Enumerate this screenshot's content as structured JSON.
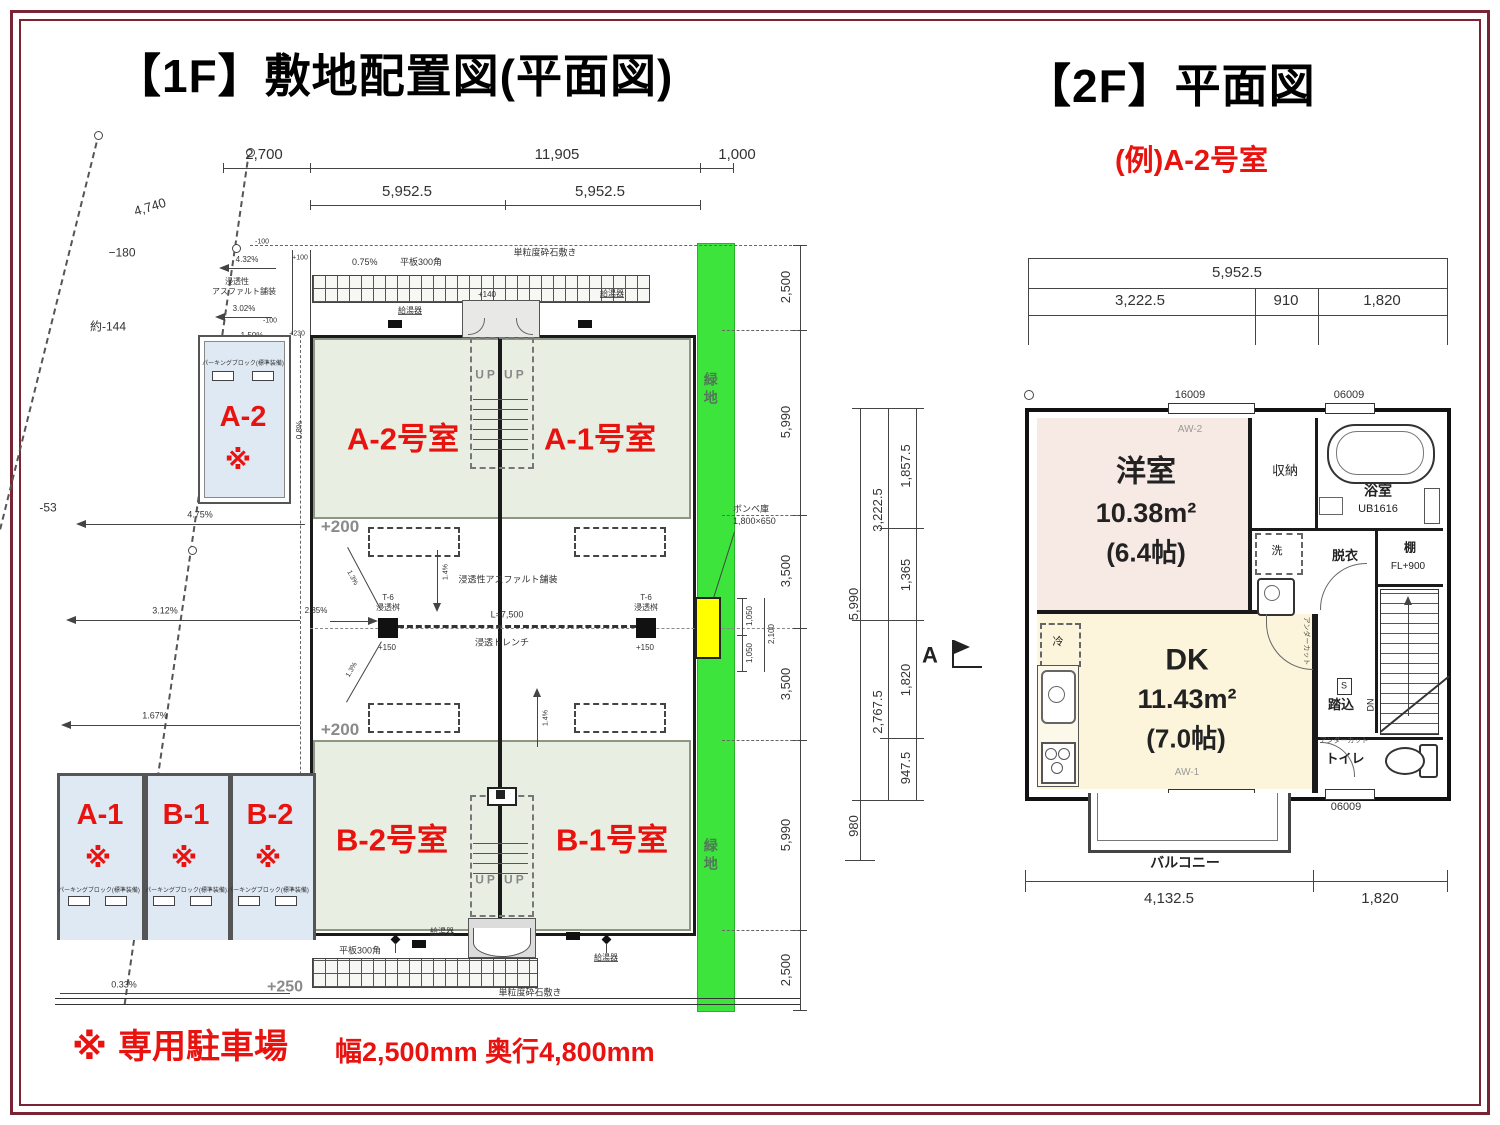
{
  "f1": {
    "title": "【1F】敷地配置図(平面図)",
    "top_dims": {
      "d2700": "2,700",
      "d11905": "11,905",
      "d1000": "1,000",
      "d5952": "5,952.5"
    },
    "right_dims": [
      "2,500",
      "5,990",
      "3,500",
      "3,500",
      "5,990",
      "2,500"
    ],
    "small_dims": {
      "d1050": "1,050",
      "d2100": "2,100"
    },
    "boundary": {
      "d4740": "4,740",
      "d180": "−180",
      "d144": "約-144",
      "d53": "-53"
    },
    "slopes": {
      "s432": "4.32%",
      "s302": "3.02%",
      "s150": "1.50%",
      "s475": "4.75%",
      "s312": "3.12%",
      "s235": "2.35%",
      "s167": "1.67%",
      "s033": "0.33%",
      "s08": "0.8%",
      "s14": "1.4%",
      "s13": "1.3%",
      "s075": "0.75%"
    },
    "levels": {
      "m100": "-100",
      "p100": "+100",
      "p230": "+230",
      "p140": "+140",
      "p150": "+150",
      "p200": "+200",
      "p250": "+250"
    },
    "labels": {
      "asphalt1": "浸透性",
      "asphalt2": "アスファルト舗装",
      "asphalt_mid": "浸透性アスファルト舗装",
      "gravel": "単粒度砕石敷き",
      "tile": "平板300角",
      "heater": "給湯器",
      "t6": "T-6",
      "masu": "浸透桝",
      "trench_l": "L=7,500",
      "trench": "浸透トレンチ",
      "bombe": "ボンベ庫",
      "bombe_size": "1,800×650",
      "green": "緑地",
      "up": "UP UP",
      "parking_block": "パーキングブロック(標準装備)"
    },
    "rooms": {
      "a2": "A-2号室",
      "a1": "A-1号室",
      "b2": "B-2号室",
      "b1": "B-1号室"
    },
    "parking": {
      "a2": "A-2",
      "a1": "A-1",
      "b1": "B-1",
      "b2": "B-2",
      "mark": "※"
    }
  },
  "f2": {
    "title": "【2F】平面図",
    "subtitle": "(例)A-2号室",
    "top_dims": {
      "total": "5,952.5",
      "d1": "3,222.5",
      "d2": "910",
      "d3": "1,820"
    },
    "left_dims": {
      "outer": "5,990",
      "g1": "3,222.5",
      "g1a": "1,857.5",
      "g1b": "1,365",
      "g2": "2,767.5",
      "g2a": "1,820",
      "g2b": "947.5",
      "balc": "980"
    },
    "bottom_dims": {
      "d1": "4,132.5",
      "d2": "1,820"
    },
    "marker": "A",
    "windows": {
      "w16009": "16009",
      "w06009": "06009",
      "w16018": "16018",
      "aw2": "AW-2",
      "aw1": "AW-1"
    },
    "rooms": {
      "yo": {
        "name": "洋室",
        "area": "10.38m²",
        "mats": "(6.4帖)"
      },
      "dk": {
        "name": "DK",
        "area": "11.43m²",
        "mats": "(7.0帖)"
      },
      "closet": "収納",
      "bath": "浴室",
      "ub": "UB1616",
      "wash": "洗",
      "datsui": "脱衣",
      "shelf": "棚",
      "fl": "FL+900",
      "fumikomi": "踏込",
      "s": "S",
      "dn": "DN",
      "toilet": "トイレ",
      "fridge": "冷",
      "balcony": "バルコニー",
      "undercut": "アンダーカット"
    }
  },
  "note": {
    "mark": "※",
    "title": "専用駐車場",
    "detail": "幅2,500mm 奥行4,800mm"
  },
  "colors": {
    "accent_red": "#e8120f",
    "green_strip": "#3ce43c",
    "bombe_yellow": "#ffff00",
    "frame": "#7a2433"
  }
}
